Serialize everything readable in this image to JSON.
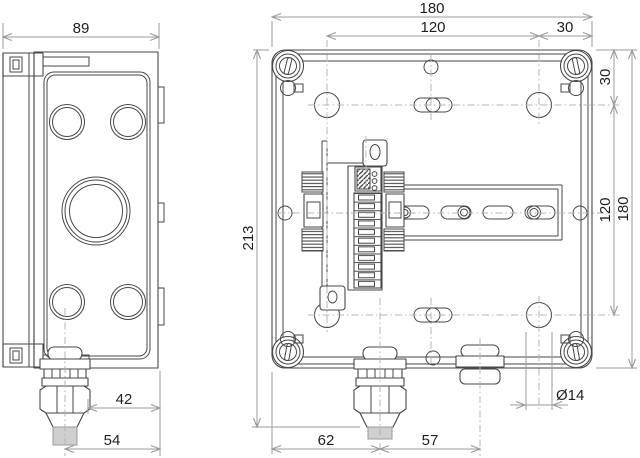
{
  "drawing": {
    "kind": "technical-dimension-drawing",
    "subject": "wall-mount enclosure with DIN rail and terminal device, side view and open front view",
    "colors": {
      "background": "#ffffff",
      "outline": "#474747",
      "dimension_lines": "#9b9b9b",
      "centerlines": "#b5b5b5",
      "text": "#1f1f1f",
      "cable_stub_fill": "#cfcfcf"
    }
  },
  "labels": {
    "side_depth": "89",
    "front_width": "180",
    "top_hole_pitch": "120",
    "top_right_margin": "30",
    "right_top_margin": "30",
    "right_hole_pitch": "120",
    "right_height": "180",
    "overall_height": "213",
    "side_gland_offset": "42",
    "side_gland_center": "54",
    "bottom_gland_offset": "62",
    "bottom_gland_pitch": "57",
    "hole_diameter": "Ø14"
  }
}
